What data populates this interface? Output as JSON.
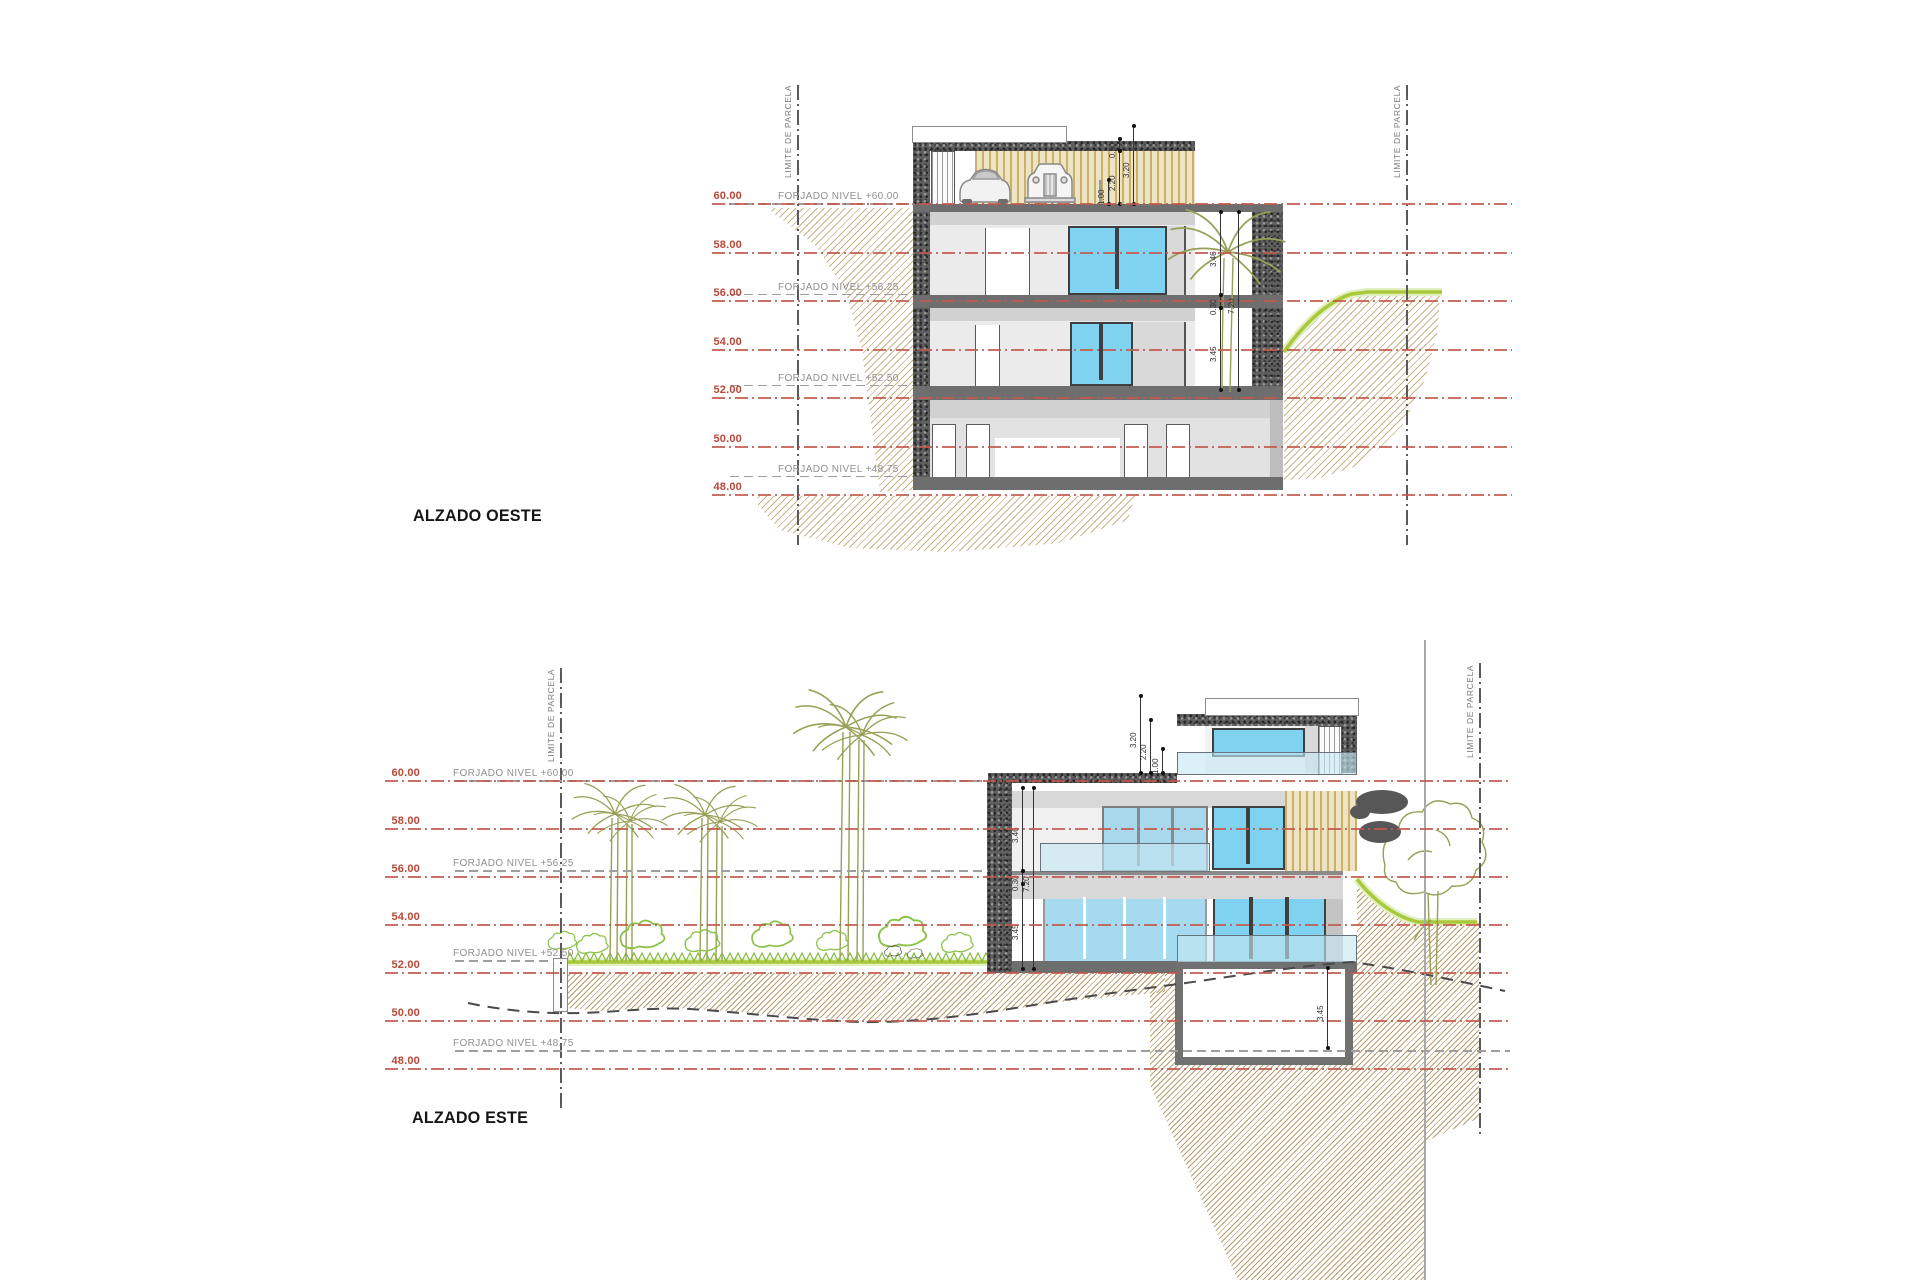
{
  "sheet": {
    "kind": "architectural elevation sheet",
    "scale_levels_m": [
      60,
      58,
      56,
      54,
      52,
      50,
      48
    ]
  },
  "drawing": {
    "parcel_label": "LIMITE DE PARCELA",
    "west": {
      "title": "ALZADO OESTE",
      "levels": [
        {
          "elev": 60,
          "label": "60.00"
        },
        {
          "elev": 58,
          "label": "58.00"
        },
        {
          "elev": 56,
          "label": "56.00"
        },
        {
          "elev": 54,
          "label": "54.00"
        },
        {
          "elev": 52,
          "label": "52.00"
        },
        {
          "elev": 50,
          "label": "50.00"
        },
        {
          "elev": 48,
          "label": "48.00"
        }
      ],
      "forjado": [
        {
          "elev": 60.0,
          "label": "FORJADO NIVEL +60.00",
          "x1": 730,
          "x2": 913
        },
        {
          "elev": 56.25,
          "label": "FORJADO NIVEL +56.25",
          "x1": 730,
          "x2": 913
        },
        {
          "elev": 52.5,
          "label": "FORJADO NIVEL +52.50",
          "x1": 730,
          "x2": 913
        },
        {
          "elev": 48.75,
          "label": "FORJADO NIVEL +48.75",
          "x1": 730,
          "x2": 913
        }
      ],
      "dims": [
        {
          "label": "1.00",
          "x": 1108,
          "top": 180,
          "bot": 204
        },
        {
          "label": "2.20",
          "x": 1119,
          "top": 151,
          "bot": 204
        },
        {
          "label": "0.50",
          "x": 1119,
          "top": 139,
          "bot": 151
        },
        {
          "label": "3.20",
          "x": 1133,
          "top": 126,
          "bot": 204
        },
        {
          "label": "3.46",
          "x": 1220,
          "top": 212,
          "bot": 295
        },
        {
          "label": "0.30",
          "x": 1220,
          "top": 295,
          "bot": 308
        },
        {
          "label": "3.45",
          "x": 1220,
          "top": 308,
          "bot": 390
        },
        {
          "label": "7.20",
          "x": 1238,
          "top": 212,
          "bot": 390
        }
      ],
      "geom": {
        "y60": 204,
        "px_per_m": 24.25,
        "line_x1": 712,
        "line_x2": 1512,
        "label_x": 742,
        "forjado_label_x": 778
      }
    },
    "east": {
      "title": "ALZADO ESTE",
      "levels": [
        {
          "elev": 60,
          "label": "60.00"
        },
        {
          "elev": 58,
          "label": "58.00"
        },
        {
          "elev": 56,
          "label": "56.00"
        },
        {
          "elev": 54,
          "label": "54.00"
        },
        {
          "elev": 52,
          "label": "52.00"
        },
        {
          "elev": 50,
          "label": "50.00"
        },
        {
          "elev": 48,
          "label": "48.00"
        }
      ],
      "forjado": [
        {
          "elev": 60.0,
          "label": "FORJADO NIVEL +60.00",
          "x1": 455,
          "x2": 988
        },
        {
          "elev": 56.25,
          "label": "FORJADO NIVEL +56.25",
          "x1": 455,
          "x2": 988
        },
        {
          "elev": 52.5,
          "label": "FORJADO NIVEL +52.50",
          "x1": 455,
          "x2": 554
        },
        {
          "elev": 48.75,
          "label": "FORJADO NIVEL +48.75",
          "x1": 455,
          "x2": 1510
        }
      ],
      "dims": [
        {
          "label": "3.20",
          "x": 1140,
          "top": 696,
          "bot": 773
        },
        {
          "label": "2.20",
          "x": 1150,
          "top": 720,
          "bot": 773
        },
        {
          "label": "1.00",
          "x": 1162,
          "top": 749,
          "bot": 773
        },
        {
          "label": "3.46",
          "x": 1022,
          "top": 788,
          "bot": 871
        },
        {
          "label": "0.30",
          "x": 1022,
          "top": 871,
          "bot": 884
        },
        {
          "label": "3.45",
          "x": 1022,
          "top": 884,
          "bot": 969
        },
        {
          "label": "7.20",
          "x": 1033,
          "top": 788,
          "bot": 969
        },
        {
          "label": "3.45",
          "x": 1327,
          "top": 968,
          "bot": 1048
        }
      ],
      "geom": {
        "y60": 781,
        "px_per_m": 24,
        "line_x1": 385,
        "line_x2": 1510,
        "label_x": 420,
        "forjado_label_x": 453
      }
    }
  },
  "colors": {
    "level_line": "#c4574a",
    "level_text": "#b9473a",
    "forjado_text": "#8f8f8f",
    "terrain_hatch": "#ac8a46",
    "grass_green": "#a9c83a",
    "glass_blue": "#7fd2f0",
    "glass_railing": "#c5e6f2",
    "slat_wood": "#d3bc7d",
    "stone_dark": "#5f5f5f"
  },
  "icons": [
    "palm-icon",
    "tree-icon",
    "shrub-icon",
    "car-icon",
    "classic-car-icon"
  ]
}
